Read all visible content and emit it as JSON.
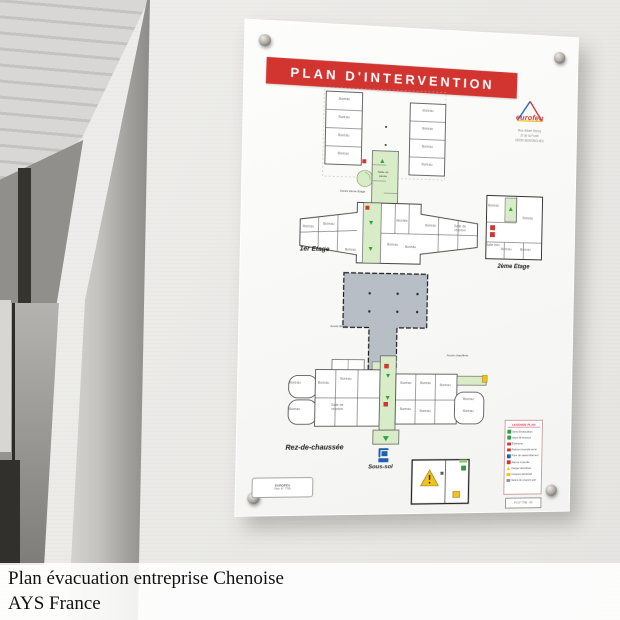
{
  "caption": {
    "line1": "Plan évacuation entreprise Chenoise",
    "line2": "AYS France"
  },
  "board": {
    "title": "PLAN D'INTERVENTION",
    "logo": {
      "brand": "eurofeu",
      "address": [
        "Rue Albert Rémy",
        "ZI de la Forêt",
        "28250 SENONCHES"
      ]
    },
    "floors": {
      "upper": {
        "access_label": "Accès 2ème Etage",
        "pause_label": "Salle de pause",
        "rooms": [
          "Bureau",
          "Bureau",
          "Bureau",
          "Bureau",
          "Bureau",
          "Bureau",
          "Bureau",
          "Bureau"
        ]
      },
      "etage1": {
        "label": "1er Etage",
        "rooms": [
          "Bureau",
          "Bureau",
          "Montée",
          "Bureau",
          "Salle de réunion",
          "Bureau",
          "Bureau",
          "Bureau"
        ]
      },
      "etage2": {
        "label": "2ème Etage",
        "rooms": [
          "Bureau",
          "Bureau",
          "Salle info",
          "Bureau",
          "Bureau"
        ]
      },
      "hangar": {
        "access_label": "Accès Etage"
      },
      "rdc": {
        "label": "Rez-de-chaussée",
        "chaufferie_label": "Accès chaufferie",
        "rooms": [
          "Bureau",
          "Bureau",
          "Bureau",
          "Bureau",
          "Salle de réunion",
          "Bureau",
          "Bureau",
          "Bureau",
          "Bureau",
          "Bureau",
          "Bureau",
          "Bureau"
        ]
      },
      "soussol": {
        "label": "Sous-sol"
      }
    },
    "legend": {
      "title": "LEGENDE PLAN",
      "ref": "PI CF 7789 - 09",
      "items": [
        {
          "color": "#2f9e3f",
          "label": "Sens d'évacuation"
        },
        {
          "color": "#2f9e3f",
          "label": "Issue de secours"
        },
        {
          "color": "#d03732",
          "label": "Extincteur"
        },
        {
          "color": "#d03732",
          "label": "Robinet incendie armé"
        },
        {
          "color": "#2060b0",
          "label": "Point de rassemblement"
        },
        {
          "color": "#d03732",
          "label": "Alarme incendie"
        },
        {
          "color": "#f2c21c",
          "label": "Danger électrique",
          "shape": "triangle"
        },
        {
          "color": "#f2c21c",
          "label": "Coupure électricité"
        },
        {
          "color": "#8f979e",
          "label": "Vanne de coupure gaz"
        }
      ]
    },
    "ref_box": {
      "line1": "EUROFEU",
      "line2": "Plan N° 7789"
    }
  },
  "colors": {
    "banner_red": "#d23430",
    "corridor_green": "#d9ecc8",
    "hangar_gray": "#b7bec6"
  }
}
